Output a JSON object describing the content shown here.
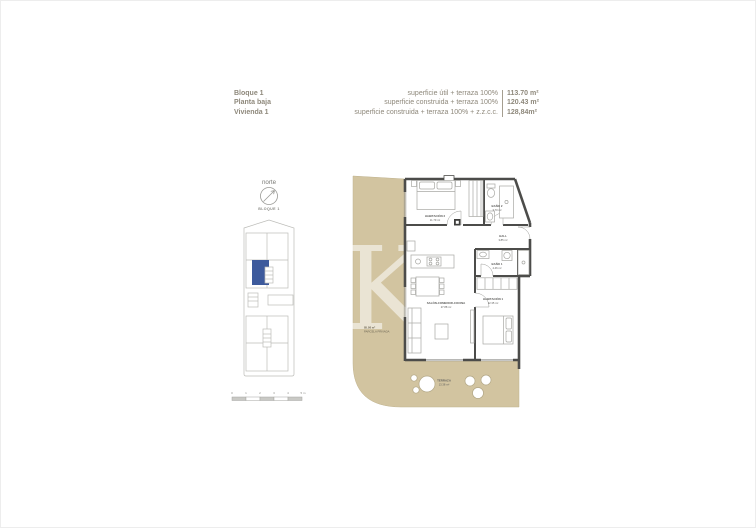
{
  "header": {
    "block": "Bloque 1",
    "floor": "Planta baja",
    "unit": "Vivienda 1",
    "areas": [
      {
        "label": "superficie útil + terraza 100%",
        "value": "113.70 m²"
      },
      {
        "label": "superficie construida + terraza 100%",
        "value": "120.43 m²"
      },
      {
        "label": "superficie construida + terraza 100% + z.z.c.c.",
        "value": "128,84m²"
      }
    ]
  },
  "siteplan": {
    "north_label": "norte",
    "block_label": "BLOQUE 1",
    "scale_ticks": [
      "0",
      "1",
      "2",
      "3",
      "4",
      "5 m"
    ]
  },
  "plan": {
    "watermark": "K",
    "parcel_area": "85.08 m²",
    "parcel_label": "PARCELA PRIVADA",
    "rooms": {
      "hab2": {
        "name": "HABITACIÓN 2",
        "area": "11.79 m²"
      },
      "bano2": {
        "name": "BAÑO 2",
        "area": "3.70 m²"
      },
      "hall": {
        "name": "HALL",
        "area": "3.85 m²"
      },
      "bano1": {
        "name": "BAÑO 1",
        "area": "4.46 m²"
      },
      "salon": {
        "name": "SALÓN-COMEDOR-COCINA",
        "area": "27.88 m²"
      },
      "hab1": {
        "name": "HABITACIÓN 1",
        "area": "12.35 m²"
      },
      "terraza": {
        "name": "TERRAZA",
        "area": "13.38 m²"
      }
    }
  },
  "colors": {
    "parcel_beige": "#d2c4a0",
    "wall_dark": "#4c4c4a",
    "selected_unit_blue": "#3d5a9c",
    "header_text": "#8e887b"
  }
}
